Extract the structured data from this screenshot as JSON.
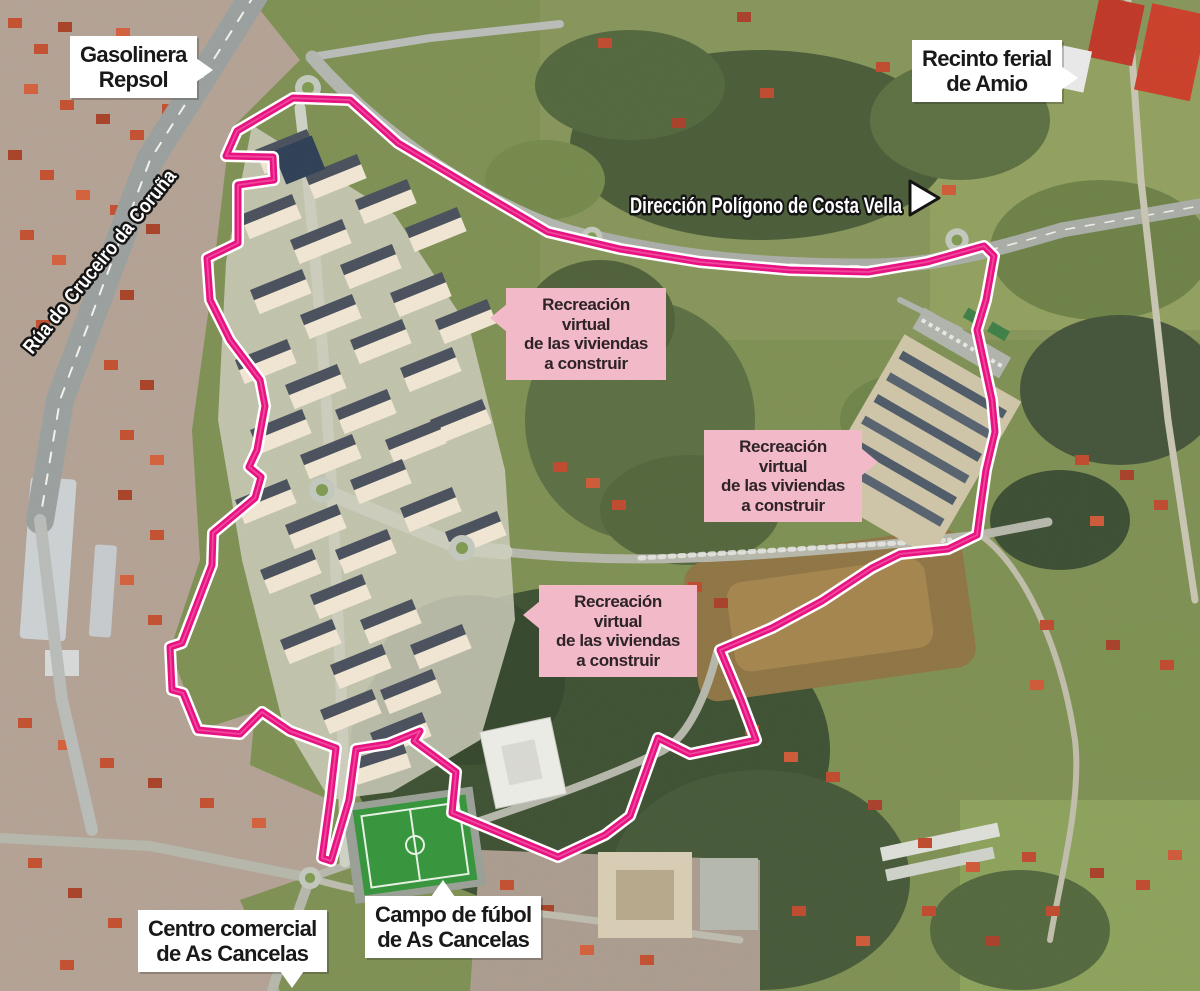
{
  "callouts": {
    "gasolinera": {
      "line1": "Gasolinera",
      "line2": "Repsol"
    },
    "recinto": {
      "line1": "Recinto ferial",
      "line2": "de Amio"
    },
    "direccion": {
      "text": "Dirección Polígono de Costa Vella"
    },
    "rua": {
      "text": "Rúa do Cruceiro da Coruña"
    },
    "centro": {
      "line1": "Centro comercial",
      "line2": "de As Cancelas"
    },
    "campo": {
      "line1": "Campo de fúbol",
      "line2": "de As Cancelas"
    }
  },
  "pink_note": {
    "line1": "Recreación",
    "line2": "virtual",
    "line3": "de las viviendas",
    "line4": "a construir",
    "bg_color": "#f2bac9",
    "text_color": "#2e2327"
  },
  "boundary": {
    "color": "#e81383",
    "casing_color": "#ffffff",
    "highlight_color": "#f褐",
    "points": "293,98 350,100 398,143 480,192 548,232 620,249 700,262 790,270 868,272 927,262 984,246 994,256 986,300 977,330 992,400 995,432 986,470 981,505 977,535 948,549 900,554 872,568 822,601 772,628 720,650 741,700 756,740 690,754 658,738 630,816 605,835 558,857 452,813 456,772 414,741 420,731 388,744 356,749 349,800 331,861 322,858 330,800 336,748 290,731 262,712 240,734 198,730 183,693 172,690 170,647 182,643 212,565 213,533 255,498 261,477 249,467 257,450 265,406 260,380 230,340 210,300 207,258 238,243 238,185 274,180 273,157 226,156 237,131"
  }
}
